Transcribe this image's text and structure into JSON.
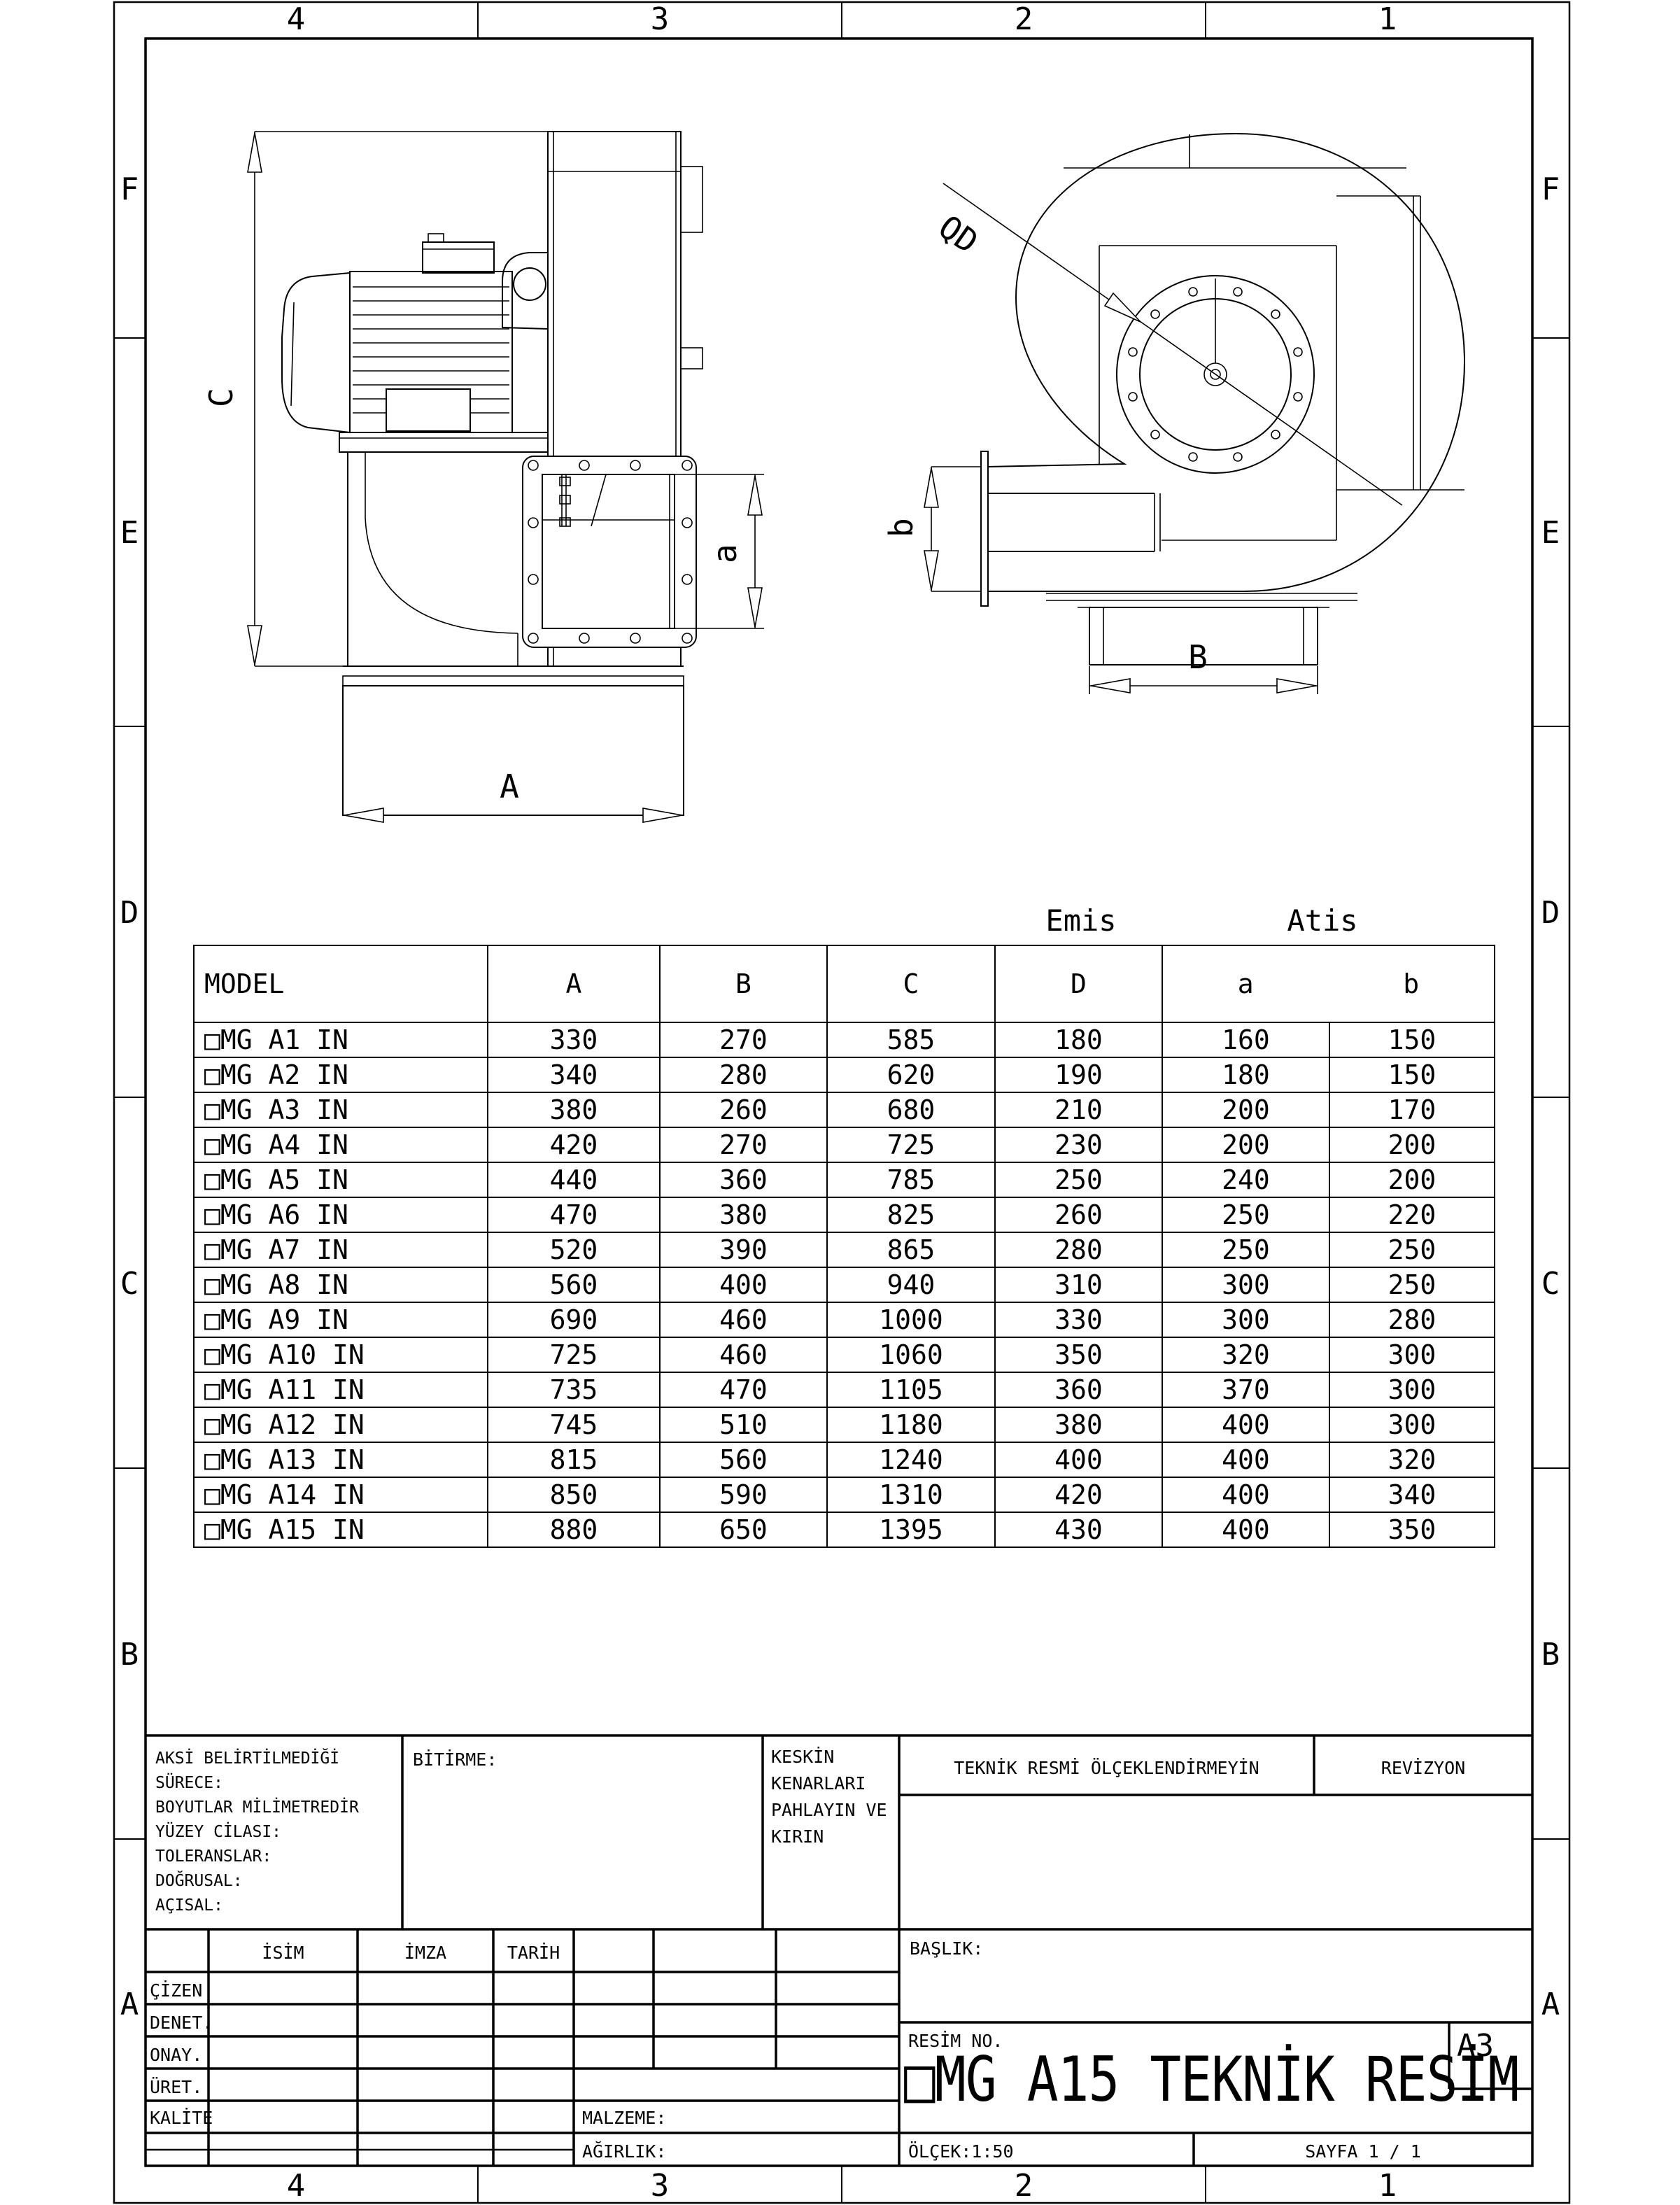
{
  "sheet": {
    "zones_top": [
      "4",
      "3",
      "2",
      "1"
    ],
    "zones_bottom": [
      "4",
      "3",
      "2",
      "1"
    ],
    "zones_left": [
      "F",
      "E",
      "D",
      "C",
      "B",
      "A"
    ],
    "zones_right": [
      "F",
      "E",
      "D",
      "C",
      "B",
      "A"
    ],
    "line_color": "#000000",
    "paper_color": "#ffffff"
  },
  "drawing": {
    "side_view": {
      "dim_height": "C",
      "dim_length": "A",
      "dim_outlet": "a"
    },
    "front_view": {
      "dim_inlet": "QD",
      "dim_width": "B",
      "dim_outlet": "b"
    }
  },
  "chart_data": {
    "type": "table",
    "title": "Fan dimension table (mm)",
    "group_labels": {
      "emis": "Emis",
      "atis": "Atis"
    },
    "columns": [
      "MODEL",
      "A",
      "B",
      "C",
      "D",
      "a",
      "b"
    ],
    "rows": [
      [
        "□MG A1 IN",
        "330",
        "270",
        "585",
        "180",
        "160",
        "150"
      ],
      [
        "□MG A2 IN",
        "340",
        "280",
        "620",
        "190",
        "180",
        "150"
      ],
      [
        "□MG A3 IN",
        "380",
        "260",
        "680",
        "210",
        "200",
        "170"
      ],
      [
        "□MG A4 IN",
        "420",
        "270",
        "725",
        "230",
        "200",
        "200"
      ],
      [
        "□MG A5 IN",
        "440",
        "360",
        "785",
        "250",
        "240",
        "200"
      ],
      [
        "□MG A6 IN",
        "470",
        "380",
        "825",
        "260",
        "250",
        "220"
      ],
      [
        "□MG A7 IN",
        "520",
        "390",
        "865",
        "280",
        "250",
        "250"
      ],
      [
        "□MG A8 IN",
        "560",
        "400",
        "940",
        "310",
        "300",
        "250"
      ],
      [
        "□MG A9 IN",
        "690",
        "460",
        "1000",
        "330",
        "300",
        "280"
      ],
      [
        "□MG A10 IN",
        "725",
        "460",
        "1060",
        "350",
        "320",
        "300"
      ],
      [
        "□MG A11 IN",
        "735",
        "470",
        "1105",
        "360",
        "370",
        "300"
      ],
      [
        "□MG A12 IN",
        "745",
        "510",
        "1180",
        "380",
        "400",
        "300"
      ],
      [
        "□MG A13 IN",
        "815",
        "560",
        "1240",
        "400",
        "400",
        "320"
      ],
      [
        "□MG A14 IN",
        "850",
        "590",
        "1310",
        "420",
        "400",
        "340"
      ],
      [
        "□MG A15 IN",
        "880",
        "650",
        "1395",
        "430",
        "400",
        "350"
      ]
    ]
  },
  "table": {
    "emis": "Emis",
    "atis": "Atis",
    "headers": {
      "model": "MODEL",
      "a": "A",
      "b": "B",
      "c": "C",
      "d": "D",
      "oa": "a",
      "ob": "b"
    }
  },
  "title_block": {
    "notes": "AKSİ BELİRTİLMEDİĞİ SÜRECE:\nBOYUTLAR MİLİMETREDİR\nYÜZEY CİLASI:\nTOLERANSLAR:\n  DOĞRUSAL:\n  AÇISAL:",
    "bitirme": "BİTİRME:",
    "keskin": "KESKİN KENARLARI\nPAHLAYIN VE\nKIRIN",
    "teknik": "TEKNİK RESMİ ÖLÇEKLENDİRMEYİN",
    "revizyon": "REVİZYON",
    "baslik": "BAŞLIK:",
    "isim": "İSİM",
    "imza": "İMZA",
    "tarih": "TARİH",
    "row_cizen": "ÇİZEN",
    "row_denet": "DENET.",
    "row_onay": "ONAY.",
    "row_uret": "ÜRET.",
    "row_kalite": "KALİTE",
    "malzeme": "MALZEME:",
    "agirlik": "AĞIRLIK:",
    "resim_no": "RESİM NO.",
    "title": "□MG A15 TEKNİK RESİM",
    "paper_size": "A3",
    "olcek": "ÖLÇEK:1:50",
    "sayfa": "SAYFA 1 / 1"
  }
}
